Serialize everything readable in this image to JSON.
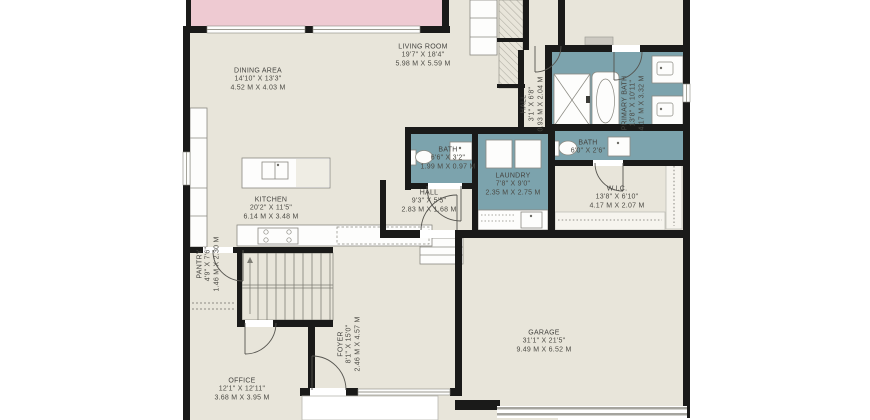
{
  "plan_type": "floor-plan",
  "rooms": {
    "dining": {
      "name": "DINING AREA",
      "imperial": "14'10\" X 13'3\"",
      "metric": "4.52 M X 4.03 M"
    },
    "living": {
      "name": "LIVING ROOM",
      "imperial": "19'7\" X 18'4\"",
      "metric": "5.98 M X 5.59 M"
    },
    "kitchen": {
      "name": "KITCHEN",
      "imperial": "20'2\" X 11'5\"",
      "metric": "6.14 M X 3.48 M"
    },
    "pantry": {
      "name": "PANTRY",
      "imperial": "4'9\" X 7'6\"",
      "metric": "1.46 M X 2.30 M"
    },
    "office": {
      "name": "OFFICE",
      "imperial": "12'1\" X 12'11\"",
      "metric": "3.68 M X 3.95 M"
    },
    "foyer": {
      "name": "FOYER",
      "imperial": "8'1\" X 15'0\"",
      "metric": "2.46 M X 4.57 M"
    },
    "hall_upper": {
      "name": "HALL",
      "imperial": "3'1\" X 6'8\"",
      "metric": "0.93 M X 2.04 M"
    },
    "hall_main": {
      "name": "HALL",
      "imperial": "9'3\" X 5'5\"",
      "metric": "2.83 M X 1.68 M"
    },
    "bath_small": {
      "name": "BATH",
      "imperial": "6'6\" X 3'2\"",
      "metric": "1.99 M X 0.97 M"
    },
    "laundry": {
      "name": "LAUNDRY",
      "imperial": "7'8\" X 9'0\"",
      "metric": "2.35 M X 2.75 M"
    },
    "bath_wc": {
      "name": "BATH",
      "imperial": "6'0\" X 2'6\"",
      "metric": ""
    },
    "wic": {
      "name": "W.I.C.",
      "imperial": "13'8\" X 6'10\"",
      "metric": "4.17 M X 2.07 M"
    },
    "primary_bath": {
      "name": "PRIMARY BATH",
      "imperial": "13'8\" X 10'11\"",
      "metric": "4.17 M X 3.32 M"
    },
    "garage": {
      "name": "GARAGE",
      "imperial": "31'1\" X 21'5\"",
      "metric": "9.49 M X 6.52 M"
    }
  },
  "colors": {
    "background": "#ffffff",
    "floor": "#e8e5da",
    "wet_room": "#7ca3ad",
    "deck": "#eecad2",
    "wall": "#1a1a19",
    "label_text": "#4b4a44",
    "fixture_outline": "#8a8981"
  }
}
